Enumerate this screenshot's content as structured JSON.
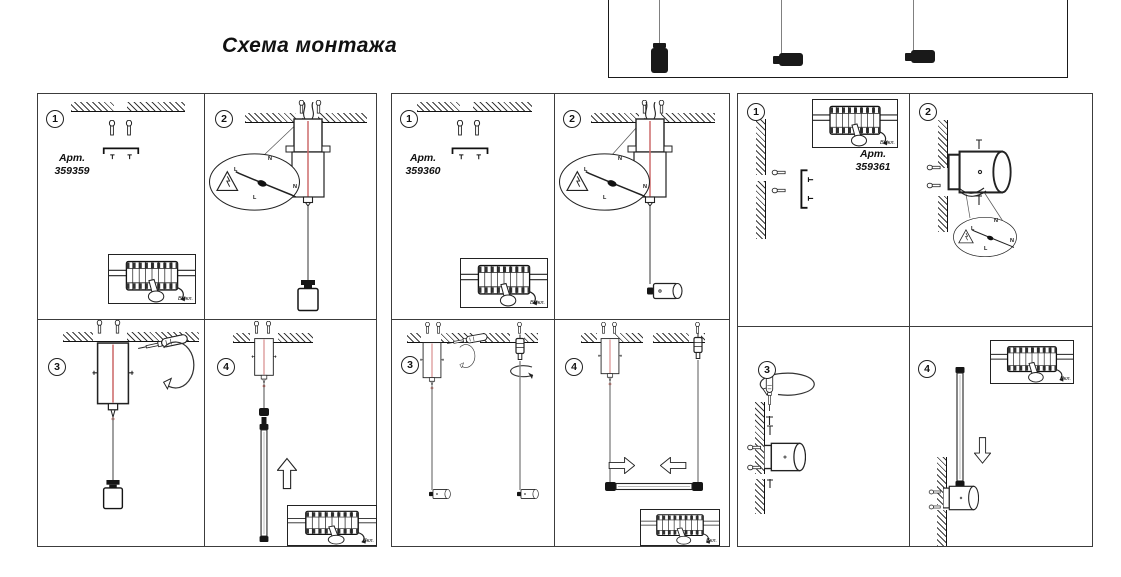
{
  "title": "Схема монтажа",
  "step_numbers": [
    "1",
    "2",
    "3",
    "4"
  ],
  "labels": {
    "art": "Арт.",
    "power_off": "Выкл.",
    "power_on": "Вкл.",
    "line": "L",
    "neutral": "N"
  },
  "panels": [
    {
      "art_number": "359359"
    },
    {
      "art_number": "359360"
    },
    {
      "art_number": "359361"
    }
  ]
}
